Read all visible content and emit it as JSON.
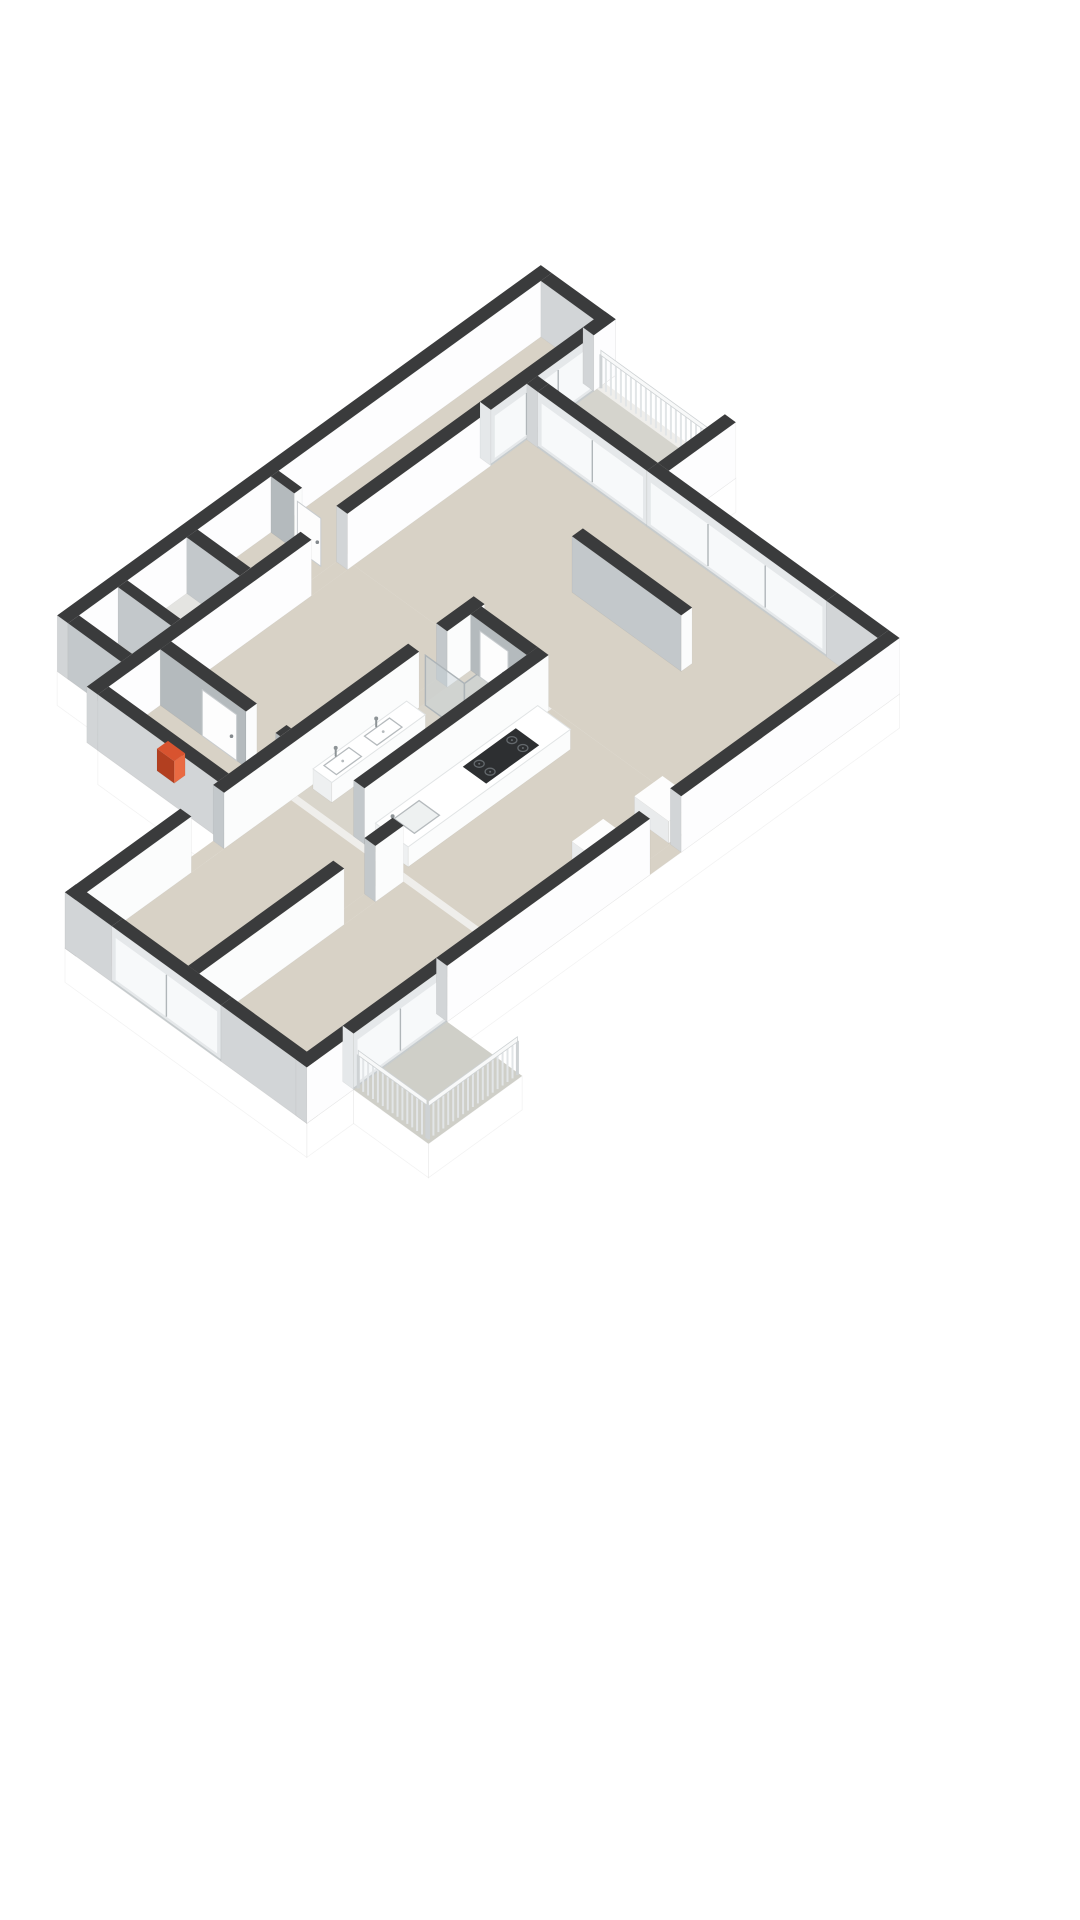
{
  "scene": {
    "width": 1080,
    "height": 1920,
    "background": "#ffffff"
  },
  "projection": {
    "kx": 0.78,
    "ky": 0.565,
    "ox": -130,
    "oy": 807,
    "wallH": 56,
    "skirt": 34,
    "railH": 38
  },
  "palette": {
    "wallTop": "#3a3b3c",
    "extSW": "#d2d5d7",
    "extSE": "#fdfdfe",
    "intSW": "#c3c8cb",
    "intSE": "#fbfcfc",
    "intdSW": "#b4babd",
    "floor": "#d8d2c6",
    "floorBath": "#d9d5cb",
    "floorPale": "#e4e4e1",
    "floorBalc1": "#d5d4cd",
    "floorBalc2": "#cfcfc8",
    "slabTop": "#efeeeb",
    "skirt": "#ffffff",
    "skirtEdge": "rgba(0,0,0,0.05)",
    "glassFrame": "#e5e8ea",
    "glass": "#f7f9fa",
    "mullion": "#b0b6b9",
    "sill": "#c6cbcd",
    "counterTop": "#ffffff",
    "counterSW": "#eef0f1",
    "counterSE": "#fbfcfc",
    "counterEdge": "#e1e4e5",
    "cabTop": "#fdfdfd",
    "cabSW": "#e9ebec",
    "cabSE": "#f8f9f9",
    "cooktop": "#2d2f31",
    "burner": "#63686c",
    "fixture": "#b5babd",
    "fixtureFill": "#ffffff",
    "metal": "#8d9396",
    "railSlat": "#e2e5e7",
    "railBar": "#f8f9f9",
    "railEdge": "#ced2d4",
    "redTop": "#d8532f",
    "redSW": "#b23f20",
    "redSE": "#e96a42",
    "showerGlass": "rgba(198,209,215,0.45)",
    "showerFrame": "#adb4b8",
    "doorFill": "#fdfdfd",
    "doorEdge": "#c8cccf",
    "handle": "#84898d",
    "faceEdge": "rgba(0,0,0,0.06)"
  },
  "slab": {
    "outline": [
      [
        240,
        0
      ],
      [
        860,
        0
      ],
      [
        860,
        96
      ],
      [
        846,
        96
      ],
      [
        846,
        264
      ],
      [
        760,
        264
      ],
      [
        760,
        560
      ],
      [
        180,
        560
      ],
      [
        180,
        656
      ],
      [
        60,
        656
      ],
      [
        60,
        560
      ],
      [
        0,
        560
      ],
      [
        0,
        250
      ],
      [
        196,
        250
      ],
      [
        196,
        96
      ],
      [
        240,
        96
      ]
    ],
    "skirtEdges": [
      [
        [
          846,
          264
        ],
        [
          760,
          264
        ]
      ],
      [
        [
          760,
          560
        ],
        [
          180,
          560
        ]
      ],
      [
        [
          180,
          656
        ],
        [
          60,
          656
        ]
      ],
      [
        [
          60,
          656
        ],
        [
          60,
          560
        ]
      ],
      [
        [
          60,
          560
        ],
        [
          0,
          560
        ]
      ],
      [
        [
          0,
          560
        ],
        [
          0,
          250
        ]
      ],
      [
        [
          196,
          250
        ],
        [
          196,
          96
        ]
      ],
      [
        [
          240,
          96
        ],
        [
          240,
          0
        ]
      ]
    ]
  },
  "shapes": [
    {
      "n": "floor-slab",
      "t": "slab"
    },
    {
      "n": "floor-top-wing",
      "t": "floor",
      "r": [
        406,
        14,
        846,
        82
      ],
      "c": "floor"
    },
    {
      "n": "floor-closets-top",
      "t": "floor",
      "r": [
        254,
        14,
        392,
        82
      ],
      "c": "floorPale"
    },
    {
      "n": "floor-door-gap-wing",
      "t": "floor",
      "r": [
        470,
        82,
        516,
        96
      ],
      "c": "floor"
    },
    {
      "n": "floor-hallway",
      "t": "floor",
      "r": [
        210,
        96,
        524,
        250
      ],
      "c": "floor"
    },
    {
      "n": "floor-balcony-right",
      "t": "floor",
      "r": [
        760,
        96,
        836,
        252
      ],
      "c": "floorBalc1"
    },
    {
      "n": "floor-living-room",
      "t": "floor",
      "r": [
        524,
        96,
        746,
        546
      ],
      "c": "floor"
    },
    {
      "n": "floor-kitchen",
      "t": "floor",
      "r": [
        284,
        350,
        524,
        546
      ],
      "c": "floor"
    },
    {
      "n": "floor-bathroom",
      "t": "floor",
      "r": [
        284,
        264,
        520,
        336
      ],
      "c": "floorBath"
    },
    {
      "n": "floor-bedroom-left",
      "t": "floor",
      "r": [
        14,
        264,
        276,
        394
      ],
      "c": "floor"
    },
    {
      "n": "floor-bedroom-bottom",
      "t": "floor",
      "r": [
        14,
        408,
        276,
        546
      ],
      "c": "floor"
    },
    {
      "n": "floor-door-gap-bedroom",
      "t": "floor",
      "r": [
        148,
        250,
        190,
        264
      ],
      "c": "floor"
    },
    {
      "n": "floor-door-gap-bath",
      "t": "floor",
      "r": [
        440,
        250,
        476,
        264
      ],
      "c": "floor"
    },
    {
      "n": "floor-door-gap-bedrooms",
      "t": "floor",
      "r": [
        200,
        394,
        240,
        408
      ],
      "c": "floor"
    },
    {
      "n": "floor-door-gap-se",
      "t": "floor",
      "r": [
        440,
        546,
        480,
        560
      ],
      "c": "floor"
    },
    {
      "n": "floor-balcony-bottom",
      "t": "floor",
      "r": [
        60,
        560,
        180,
        656
      ],
      "c": "floorBalc2"
    },
    {
      "n": "wall-wing-nw",
      "t": "box",
      "r": [
        240,
        0,
        860,
        14
      ],
      "h": 56,
      "k": "ext"
    },
    {
      "n": "wall-wing-ne",
      "t": "box",
      "r": [
        846,
        14,
        860,
        96
      ],
      "h": 56,
      "k": "ext"
    },
    {
      "n": "wall-wing-cap-sw",
      "t": "box",
      "r": [
        240,
        14,
        254,
        82
      ],
      "h": 56,
      "k": "int"
    },
    {
      "n": "wall-closet-divider",
      "t": "box",
      "r": [
        304,
        14,
        316,
        82
      ],
      "h": 56,
      "k": "int"
    },
    {
      "n": "wall-closet-east",
      "t": "box",
      "r": [
        392,
        14,
        406,
        82
      ],
      "h": 56,
      "k": "int"
    },
    {
      "n": "wall-wing-lobby",
      "t": "box",
      "r": [
        500,
        14,
        510,
        44
      ],
      "h": 56,
      "k": "intd"
    },
    {
      "n": "door-wing-lobby",
      "t": "door",
      "axis": "u",
      "at": 502,
      "from": 46,
      "to": 76,
      "h": 48
    },
    {
      "n": "wall-wing-se-a",
      "t": "box",
      "r": [
        196,
        82,
        470,
        96
      ],
      "h": 56,
      "k": "ext"
    },
    {
      "n": "wall-wing-se-b",
      "t": "box",
      "r": [
        516,
        82,
        700,
        96
      ],
      "h": 56,
      "k": "ext"
    },
    {
      "n": "window-wing-end",
      "t": "glassU",
      "r": [
        700,
        82,
        832,
        96
      ],
      "h": 56,
      "panes": 3
    },
    {
      "n": "wall-wing-se-corner",
      "t": "box",
      "r": [
        832,
        82,
        860,
        96
      ],
      "h": 56,
      "k": "ext"
    },
    {
      "n": "wall-hall-cap-west",
      "t": "box",
      "r": [
        196,
        96,
        210,
        250
      ],
      "h": 56,
      "k": "ext"
    },
    {
      "n": "heater-unit",
      "t": "box",
      "r": [
        216,
        152,
        230,
        174
      ],
      "h": 22,
      "k": "red"
    },
    {
      "n": "wall-hall-divider-a",
      "t": "box",
      "r": [
        276,
        96,
        290,
        206
      ],
      "h": 56,
      "k": "intd"
    },
    {
      "n": "wall-hall-divider-b",
      "t": "box",
      "r": [
        276,
        244,
        290,
        250
      ],
      "h": 56,
      "k": "intd"
    },
    {
      "n": "door-hall-closet",
      "t": "door",
      "axis": "u",
      "at": 276,
      "from": 150,
      "to": 194,
      "h": 46
    },
    {
      "n": "railing-balcony-right",
      "t": "rail",
      "a": [
        839,
        98
      ],
      "b": [
        839,
        252
      ]
    },
    {
      "n": "wall-balcony-stub",
      "t": "box",
      "r": [
        760,
        250,
        846,
        264
      ],
      "h": 56,
      "k": "ext"
    },
    {
      "n": "wall-living-ne-corner",
      "t": "box",
      "r": [
        746,
        96,
        760,
        110
      ],
      "h": 56,
      "k": "ext"
    },
    {
      "n": "window-living-balcony-door",
      "t": "glassV",
      "r": [
        746,
        110,
        760,
        250
      ],
      "h": 56,
      "panes": 2
    },
    {
      "n": "window-living-ne",
      "t": "glassV",
      "r": [
        746,
        250,
        760,
        480
      ],
      "h": 56,
      "panes": 3
    },
    {
      "n": "wall-living-ne-solid",
      "t": "box",
      "r": [
        746,
        480,
        760,
        546
      ],
      "h": 56,
      "k": "ext"
    },
    {
      "n": "wall-hall-south-a",
      "t": "box",
      "r": [
        0,
        250,
        148,
        264
      ],
      "h": 56,
      "k": "int"
    },
    {
      "n": "wall-hall-south-b",
      "t": "box",
      "r": [
        190,
        250,
        440,
        264
      ],
      "h": 56,
      "k": "int"
    },
    {
      "n": "wall-hall-south-c",
      "t": "box",
      "r": [
        476,
        250,
        524,
        264
      ],
      "h": 56,
      "k": "int"
    },
    {
      "n": "vanity-bathroom",
      "t": "box",
      "r": [
        300,
        268,
        420,
        292
      ],
      "h": 20,
      "k": "counter"
    },
    {
      "n": "basin-left",
      "t": "basin",
      "r": [
        310,
        272,
        342,
        288
      ],
      "z": 20
    },
    {
      "n": "basin-right",
      "t": "basin",
      "r": [
        362,
        272,
        394,
        288
      ],
      "z": 20
    },
    {
      "n": "faucet-basin-left",
      "t": "faucet",
      "at": [
        326,
        271
      ],
      "z": 20
    },
    {
      "n": "faucet-basin-right",
      "t": "faucet",
      "at": [
        378,
        271
      ],
      "z": 20
    },
    {
      "n": "shower-glass-side",
      "t": "pane",
      "axis": "u",
      "at": 446,
      "from": 266,
      "to": 316,
      "h": 50
    },
    {
      "n": "shower-glass-front",
      "t": "pane",
      "axis": "v",
      "at": 316,
      "from": 446,
      "to": 516,
      "h": 50
    },
    {
      "n": "wall-bathroom-east",
      "t": "box",
      "r": [
        506,
        264,
        520,
        336
      ],
      "h": 56,
      "k": "intd"
    },
    {
      "n": "door-bathroom",
      "t": "door",
      "axis": "u",
      "at": 506,
      "from": 276,
      "to": 312,
      "h": 46
    },
    {
      "n": "wall-bath-kitchen",
      "t": "box",
      "r": [
        284,
        336,
        520,
        350
      ],
      "h": 56,
      "k": "int"
    },
    {
      "n": "kitchen-counter",
      "t": "box",
      "r": [
        292,
        356,
        500,
        398
      ],
      "h": 20,
      "k": "counter"
    },
    {
      "n": "cooktop",
      "t": "cooktop",
      "r": [
        398,
        362,
        466,
        392
      ],
      "z": 20
    },
    {
      "n": "kitchen-sink",
      "t": "sinkK",
      "r": [
        308,
        364,
        340,
        390
      ],
      "z": 20
    },
    {
      "n": "faucet-kitchen",
      "t": "faucet",
      "at": [
        302,
        368
      ],
      "z": 20
    },
    {
      "n": "kitchen-cabinet-a",
      "t": "box",
      "r": [
        400,
        500,
        440,
        544
      ],
      "h": 22,
      "k": "cab"
    },
    {
      "n": "kitchen-cabinet-b",
      "t": "box",
      "r": [
        480,
        500,
        516,
        544
      ],
      "h": 22,
      "k": "cab"
    },
    {
      "n": "wall-living-partition",
      "t": "box",
      "r": [
        640,
        260,
        654,
        400
      ],
      "h": 56,
      "k": "int"
    },
    {
      "n": "wall-bedroom-divider-a",
      "t": "box",
      "r": [
        14,
        394,
        200,
        408
      ],
      "h": 56,
      "k": "int"
    },
    {
      "n": "wall-bedroom-divider-b",
      "t": "box",
      "r": [
        240,
        394,
        276,
        408
      ],
      "h": 56,
      "k": "int"
    },
    {
      "n": "wall-west-a",
      "t": "box",
      "r": [
        0,
        250,
        14,
        310
      ],
      "h": 56,
      "k": "ext"
    },
    {
      "n": "window-bedroom-west",
      "t": "glassV",
      "r": [
        0,
        310,
        14,
        450
      ],
      "h": 56,
      "panes": 2
    },
    {
      "n": "wall-west-b",
      "t": "box",
      "r": [
        0,
        450,
        14,
        560
      ],
      "h": 56,
      "k": "ext"
    },
    {
      "n": "wall-se-a",
      "t": "box",
      "r": [
        0,
        546,
        60,
        560
      ],
      "h": 56,
      "k": "ext"
    },
    {
      "n": "window-balcony-bottom-door",
      "t": "glassU",
      "r": [
        60,
        546,
        180,
        560
      ],
      "h": 56,
      "panes": 2
    },
    {
      "n": "wall-se-b",
      "t": "box",
      "r": [
        180,
        546,
        440,
        560
      ],
      "h": 56,
      "k": "ext"
    },
    {
      "n": "wall-se-c",
      "t": "box",
      "r": [
        480,
        546,
        760,
        560
      ],
      "h": 56,
      "k": "ext"
    },
    {
      "n": "railing-balcony-bottom-west",
      "t": "rail",
      "a": [
        64,
        562
      ],
      "b": [
        64,
        650
      ]
    },
    {
      "n": "railing-balcony-bottom-south",
      "t": "rail",
      "a": [
        64,
        652
      ],
      "b": [
        178,
        652
      ]
    }
  ]
}
